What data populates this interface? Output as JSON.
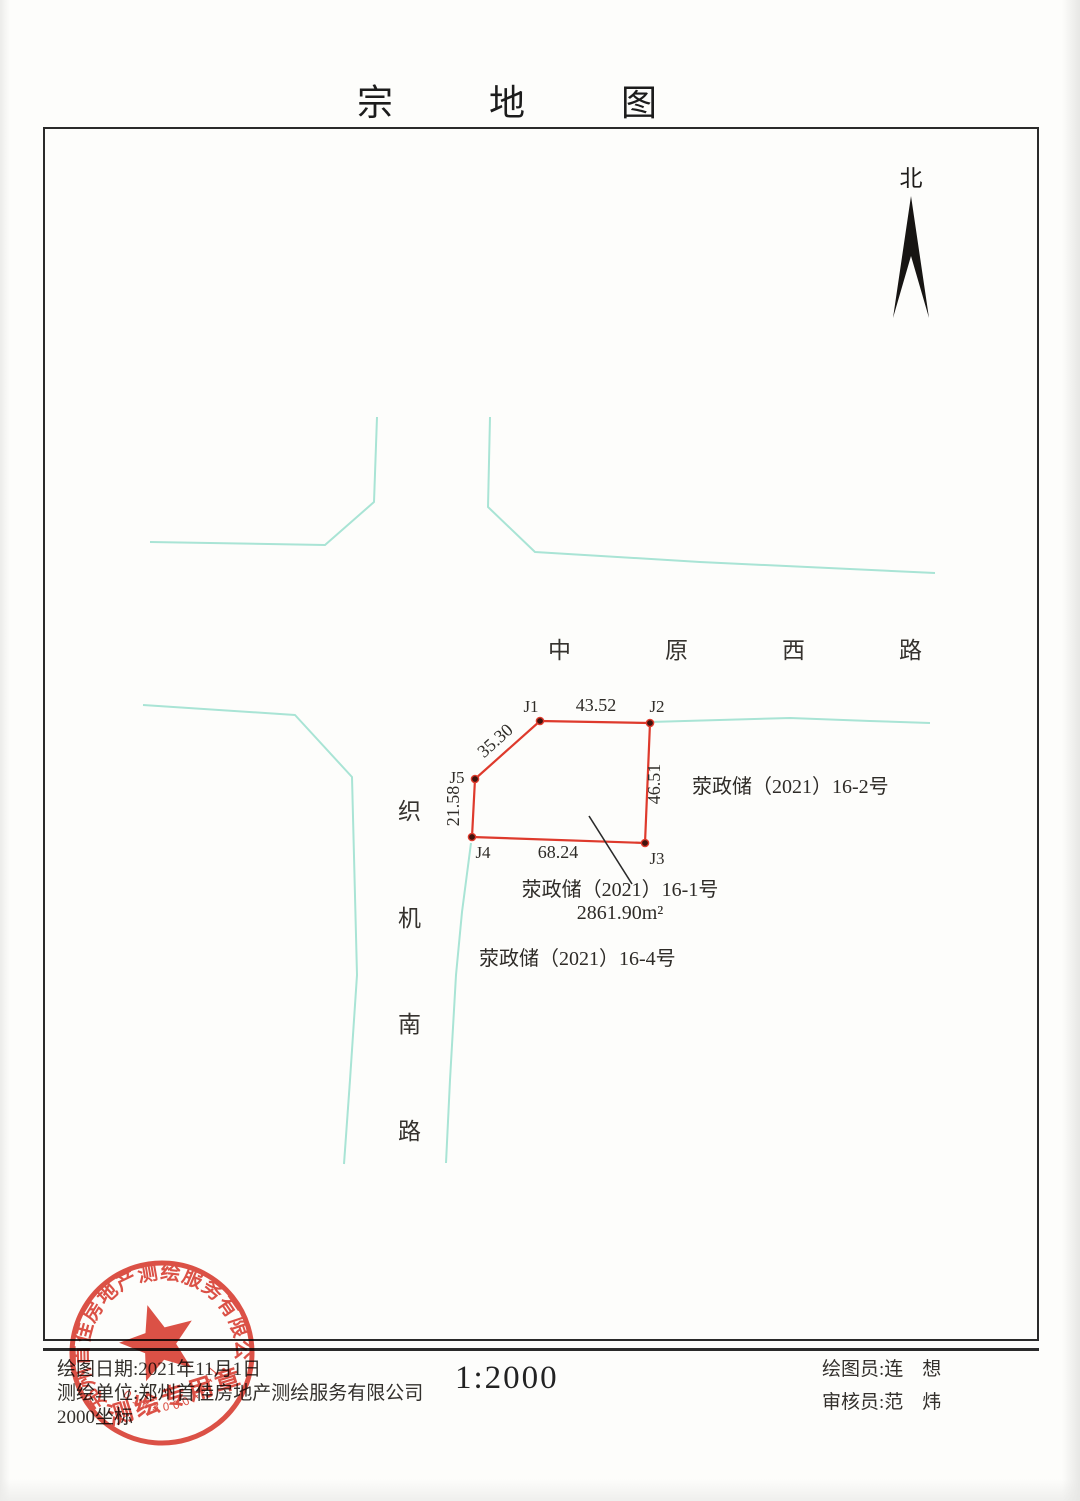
{
  "title": {
    "chars": [
      "宗",
      "地",
      "图"
    ]
  },
  "north": {
    "label": "北"
  },
  "map": {
    "roads": {
      "color": "#aae6d9",
      "name_horizontal_chars": [
        "中",
        "原",
        "西",
        "路"
      ],
      "name_vertical_chars": [
        "织",
        "机",
        "南",
        "路"
      ],
      "polylines": [
        [
          [
            150,
            542
          ],
          [
            325,
            545
          ],
          [
            374,
            502
          ],
          [
            377,
            417
          ]
        ],
        [
          [
            490,
            417
          ],
          [
            488,
            507
          ],
          [
            535,
            552
          ],
          [
            700,
            562
          ],
          [
            935,
            573
          ]
        ],
        [
          [
            143,
            705
          ],
          [
            295,
            715
          ],
          [
            352,
            777
          ],
          [
            357,
            975
          ],
          [
            350,
            1080
          ],
          [
            344,
            1164
          ]
        ],
        [
          [
            471,
            843
          ],
          [
            462,
            912
          ],
          [
            456,
            975
          ],
          [
            450,
            1080
          ],
          [
            446,
            1163
          ]
        ],
        [
          [
            650,
            722
          ],
          [
            790,
            718
          ],
          [
            870,
            721
          ],
          [
            930,
            723
          ]
        ]
      ]
    },
    "parcel": {
      "color": "#e03a2c",
      "vertices": [
        {
          "id": "J1",
          "x": 540,
          "y": 721,
          "lx": 531,
          "ly": 712
        },
        {
          "id": "J2",
          "x": 650,
          "y": 723,
          "lx": 657,
          "ly": 712
        },
        {
          "id": "J3",
          "x": 645,
          "y": 843,
          "lx": 657,
          "ly": 864
        },
        {
          "id": "J4",
          "x": 472,
          "y": 837,
          "lx": 483,
          "ly": 858
        },
        {
          "id": "J5",
          "x": 475,
          "y": 779,
          "lx": 457,
          "ly": 783
        }
      ],
      "edge_labels": [
        {
          "text": "43.52",
          "x": 596,
          "y": 711,
          "rot": 0
        },
        {
          "text": "46.51",
          "x": 660,
          "y": 784,
          "rot": -90
        },
        {
          "text": "68.24",
          "x": 558,
          "y": 858,
          "rot": 0
        },
        {
          "text": "21.58",
          "x": 459,
          "y": 806,
          "rot": -90
        },
        {
          "text": "35.30",
          "x": 499,
          "y": 745,
          "rot": -42
        }
      ],
      "leader": [
        [
          589,
          816
        ],
        [
          632,
          884
        ]
      ]
    },
    "labels": {
      "parcel_main_line1": "荥政储（2021）16-1号",
      "parcel_main_line2": "2861.90m²",
      "parcel_right": "荥政储（2021）16-2号",
      "parcel_lower": "荥政储（2021）16-4号"
    }
  },
  "seal": {
    "color": "#d8382c",
    "ring_text": "郑州首佳房地产测绘服务有限公司",
    "center_text": "测绘专用章",
    "number": "01830004947"
  },
  "footer": {
    "date": "绘图日期:2021年11月1日",
    "unit": "测绘单位:郑州首佳房地产测绘服务有限公司",
    "coord": "2000坐标",
    "scale": "1:2000",
    "drafter": "绘图员:连　想",
    "checker": "审核员:范　炜"
  }
}
